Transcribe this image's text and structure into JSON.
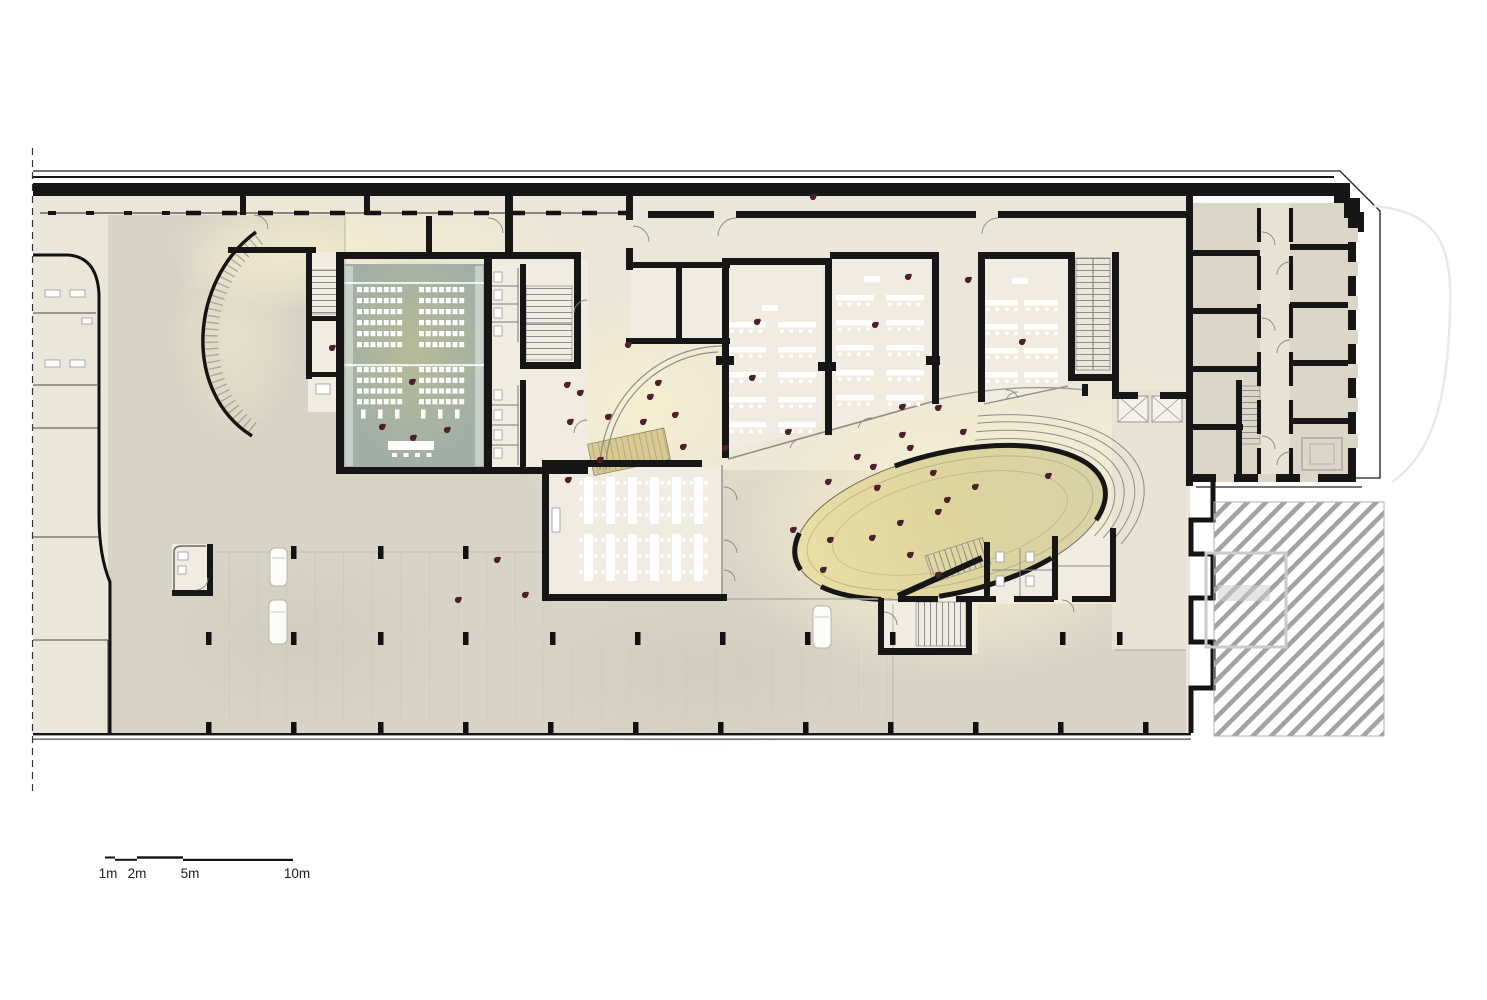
{
  "scale_bar": {
    "labels": [
      "1m",
      "2m",
      "5m",
      "10m"
    ]
  },
  "colors": {
    "wall": "#161616",
    "floor_light": "#eae6d9",
    "floor_grey": "#d7d3c6",
    "room_light": "#f0ece1",
    "wing_room": "#dbd6c8",
    "corridor": "#e7e2d4",
    "auditorium": "#a2afa7",
    "aud_glow": "#babb90",
    "ellipse_left": "#e9dea4",
    "ellipse_right": "#d8d2a8",
    "glow": "#f7f0d2",
    "stair_tan": "#d9c98f",
    "person": "#4f1f2c",
    "hatch_stripe": "#a3a3a3"
  },
  "plan": {
    "people": [
      [
        628,
        345
      ],
      [
        567,
        385
      ],
      [
        580,
        393
      ],
      [
        658,
        383
      ],
      [
        650,
        397
      ],
      [
        608,
        417
      ],
      [
        570,
        422
      ],
      [
        643,
        422
      ],
      [
        675,
        415
      ],
      [
        683,
        447
      ],
      [
        725,
        448
      ],
      [
        600,
        460
      ],
      [
        568,
        480
      ],
      [
        757,
        322
      ],
      [
        752,
        378
      ],
      [
        788,
        432
      ],
      [
        902,
        407
      ],
      [
        938,
        408
      ],
      [
        857,
        457
      ],
      [
        813,
        197
      ],
      [
        908,
        277
      ],
      [
        968,
        280
      ],
      [
        875,
        325
      ],
      [
        1022,
        342
      ],
      [
        793,
        530
      ],
      [
        828,
        482
      ],
      [
        830,
        540
      ],
      [
        872,
        538
      ],
      [
        877,
        488
      ],
      [
        900,
        523
      ],
      [
        902,
        435
      ],
      [
        910,
        448
      ],
      [
        963,
        432
      ],
      [
        873,
        467
      ],
      [
        933,
        473
      ],
      [
        938,
        512
      ],
      [
        947,
        500
      ],
      [
        975,
        487
      ],
      [
        910,
        555
      ],
      [
        823,
        570
      ],
      [
        938,
        575
      ],
      [
        412,
        382
      ],
      [
        382,
        427
      ],
      [
        413,
        438
      ],
      [
        447,
        430
      ],
      [
        497,
        560
      ],
      [
        458,
        600
      ],
      [
        525,
        595
      ],
      [
        332,
        348
      ],
      [
        1048,
        476
      ]
    ],
    "columns": {
      "size": [
        5.5,
        13
      ],
      "rows": [
        {
          "y": 546,
          "xs": [
            291,
            378,
            463
          ]
        },
        {
          "y": 632,
          "xs": [
            206,
            291,
            378,
            463,
            550,
            635,
            720,
            805,
            890,
            1060,
            1117
          ]
        },
        {
          "y": 722,
          "xs": [
            206,
            291,
            378,
            463,
            548,
            633,
            718,
            803,
            888,
            973,
            1058,
            1143
          ]
        }
      ]
    },
    "auditorium": {
      "cols": [
        357,
        419
      ],
      "per_row": 7,
      "step_x": 6.7,
      "seat": [
        5,
        5.2
      ],
      "blocks": [
        {
          "y0": 287,
          "rows": 6,
          "step_y": 11
        },
        {
          "y0": 367,
          "rows": 4,
          "step_y": 10.7
        }
      ],
      "stands": {
        "y": 409.5,
        "xs": [
          361,
          378,
          395,
          421,
          438,
          455
        ]
      }
    },
    "classrooms": [
      {
        "teacher": [
          762,
          305
        ],
        "w": 38,
        "step": 25,
        "cols": [
          {
            "x": 728,
            "y0": 322,
            "rows": 5
          },
          {
            "x": 778,
            "y0": 322,
            "rows": 5
          }
        ]
      },
      {
        "teacher": [
          864,
          276
        ],
        "w": 38,
        "step": 25,
        "cols": [
          {
            "x": 836,
            "y0": 295,
            "rows": 5
          },
          {
            "x": 886,
            "y0": 295,
            "rows": 5
          }
        ]
      },
      {
        "teacher": [
          1012,
          278
        ],
        "w": 34,
        "step": 24,
        "cols": [
          {
            "x": 984,
            "y0": 300,
            "rows": 4
          },
          {
            "x": 1024,
            "y0": 300,
            "rows": 4
          }
        ]
      }
    ],
    "cafeteria": {
      "bands": [
        {
          "y": 477,
          "h": 47
        },
        {
          "y": 534,
          "h": 47
        }
      ],
      "xs": [
        584,
        606,
        628,
        650,
        672,
        694
      ]
    }
  }
}
